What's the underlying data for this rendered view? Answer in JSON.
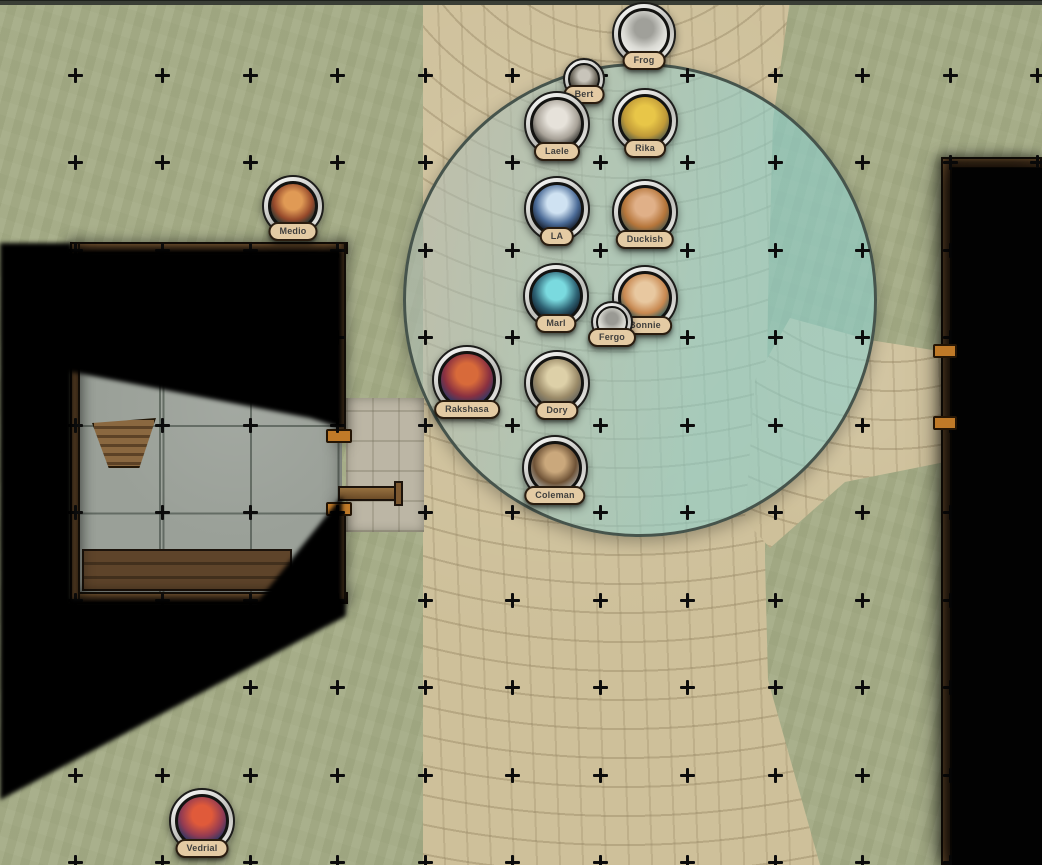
{
  "app": {
    "description": "virtual tabletop battle map with character tokens, fog of war and a light radius"
  },
  "map": {
    "colors": {
      "grass": "#a6ad88",
      "path": "#cec09a",
      "stone": "#9aa098",
      "wall": "#46321d",
      "fog": "#000000",
      "accent": "#c07a28",
      "pill": "#e4cba4",
      "pill_border": "#2a1d10",
      "top_bar": "#3a3e36",
      "grid_marker": "#0c0c0c"
    },
    "grid": {
      "spacing": 87.5,
      "origin_x": 75,
      "origin_y": 75,
      "cols": 12,
      "rows": 10,
      "marker": "plus"
    },
    "aoe_circle": {
      "cx": 640,
      "cy": 300,
      "radius": 237,
      "border_color": "#46544c",
      "fill_start": "rgba(173,187,180,0.55)",
      "fill_end": "rgba(140,207,204,0.60)"
    }
  },
  "tokens": [
    {
      "id": "bert",
      "label": "Bert",
      "x": 584,
      "y": 79,
      "size": 42,
      "colors": [
        "#c8c4ba",
        "#716c60",
        "#3c3831"
      ]
    },
    {
      "id": "frog",
      "label": "Frog",
      "x": 644,
      "y": 34,
      "size": 64,
      "colors": [
        "#a0a09a",
        "#d9d9d3",
        "#eeeeea"
      ]
    },
    {
      "id": "laele",
      "label": "Laele",
      "x": 557,
      "y": 124,
      "size": 66,
      "colors": [
        "#e6e2da",
        "#a8a298",
        "#32322e"
      ]
    },
    {
      "id": "rika",
      "label": "Rika",
      "x": 645,
      "y": 121,
      "size": 66,
      "colors": [
        "#e8c648",
        "#c09a38",
        "#4f5a4a"
      ]
    },
    {
      "id": "la",
      "label": "LA",
      "x": 557,
      "y": 209,
      "size": 66,
      "colors": [
        "#cfe2f2",
        "#4a6a96",
        "#141b28"
      ]
    },
    {
      "id": "duckish",
      "label": "Duckish",
      "x": 645,
      "y": 212,
      "size": 66,
      "colors": [
        "#e0b088",
        "#b5753a",
        "#47564c"
      ]
    },
    {
      "id": "marl",
      "label": "Marl",
      "x": 556,
      "y": 296,
      "size": 66,
      "colors": [
        "#7adadf",
        "#2e6374",
        "#101c2a"
      ]
    },
    {
      "id": "bonnie",
      "label": "Bonnie",
      "x": 645,
      "y": 298,
      "size": 66,
      "colors": [
        "#e8c8a0",
        "#c88850",
        "#2f5f62"
      ]
    },
    {
      "id": "fergo",
      "label": "Fergo",
      "x": 612,
      "y": 322,
      "size": 42,
      "colors": [
        "#9a9a94",
        "#d4d4cc",
        "#ebebe8"
      ]
    },
    {
      "id": "rakshasa",
      "label": "Rakshasa",
      "x": 467,
      "y": 380,
      "size": 70,
      "colors": [
        "#d86a3a",
        "#8a3040",
        "#2a3a6a"
      ]
    },
    {
      "id": "dory",
      "label": "Dory",
      "x": 557,
      "y": 383,
      "size": 66,
      "colors": [
        "#ddd0a8",
        "#9a8a68",
        "#62625c"
      ]
    },
    {
      "id": "coleman",
      "label": "Coleman",
      "x": 555,
      "y": 468,
      "size": 66,
      "colors": [
        "#caa87c",
        "#6e5236",
        "#a3a39e"
      ]
    },
    {
      "id": "medio",
      "label": "Medio",
      "x": 293,
      "y": 206,
      "size": 62,
      "colors": [
        "#e09a55",
        "#96492b",
        "#173433"
      ]
    },
    {
      "id": "vedrial",
      "label": "Vedrial",
      "x": 202,
      "y": 821,
      "size": 66,
      "colors": [
        "#e05a3a",
        "#933b52",
        "#263766"
      ]
    }
  ]
}
